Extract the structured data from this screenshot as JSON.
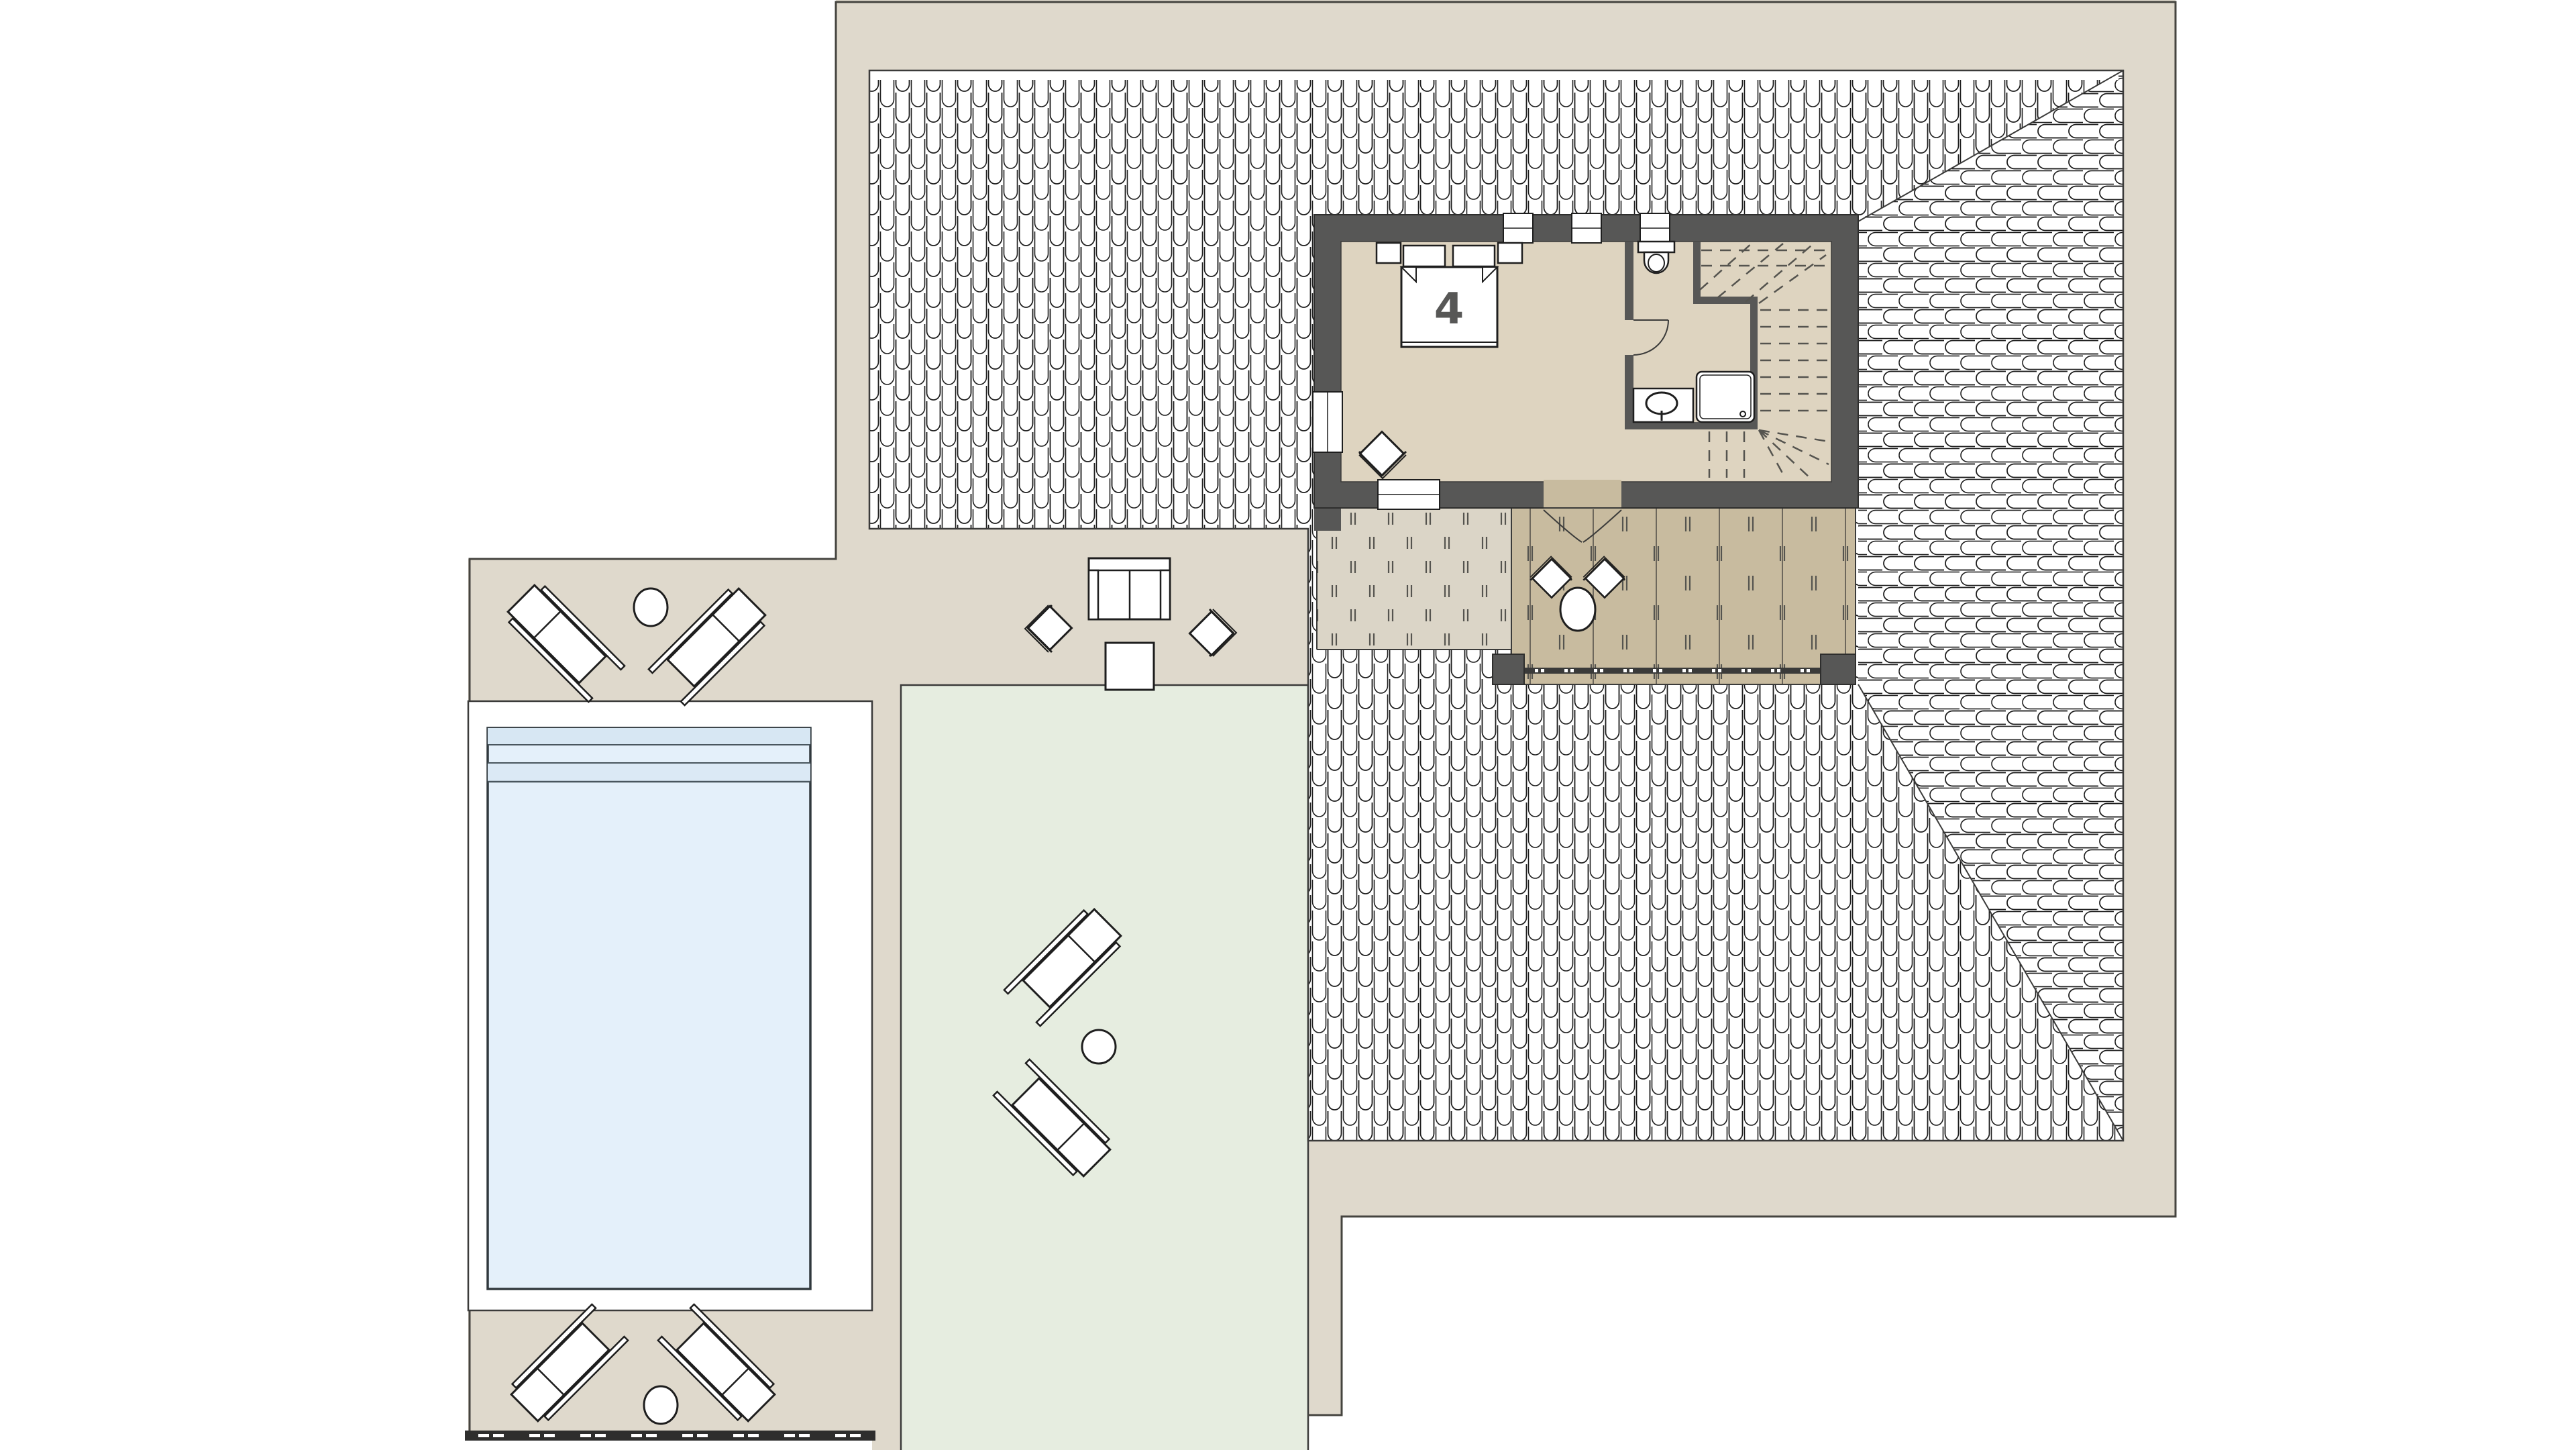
{
  "plan": {
    "room_label": "4"
  },
  "palette": {
    "page_bg": "#ffffff",
    "site": "#dfd9cc",
    "site_outline": "#45443f",
    "roof_tile_stroke": "#1e1e1e",
    "wall": "#575756",
    "interior_floor": "#ded4c0",
    "terrace_deck": "#c8bb9f",
    "balcony_deck": "#dbd5c7",
    "lawn": "#e6ede0",
    "pool_water": "#e4f0fa",
    "pool_step_band": "#d7e7f3",
    "pool_deck": "#ffffff",
    "boundary_fence": "#2e2e2d",
    "room_label_color": "#575756"
  }
}
